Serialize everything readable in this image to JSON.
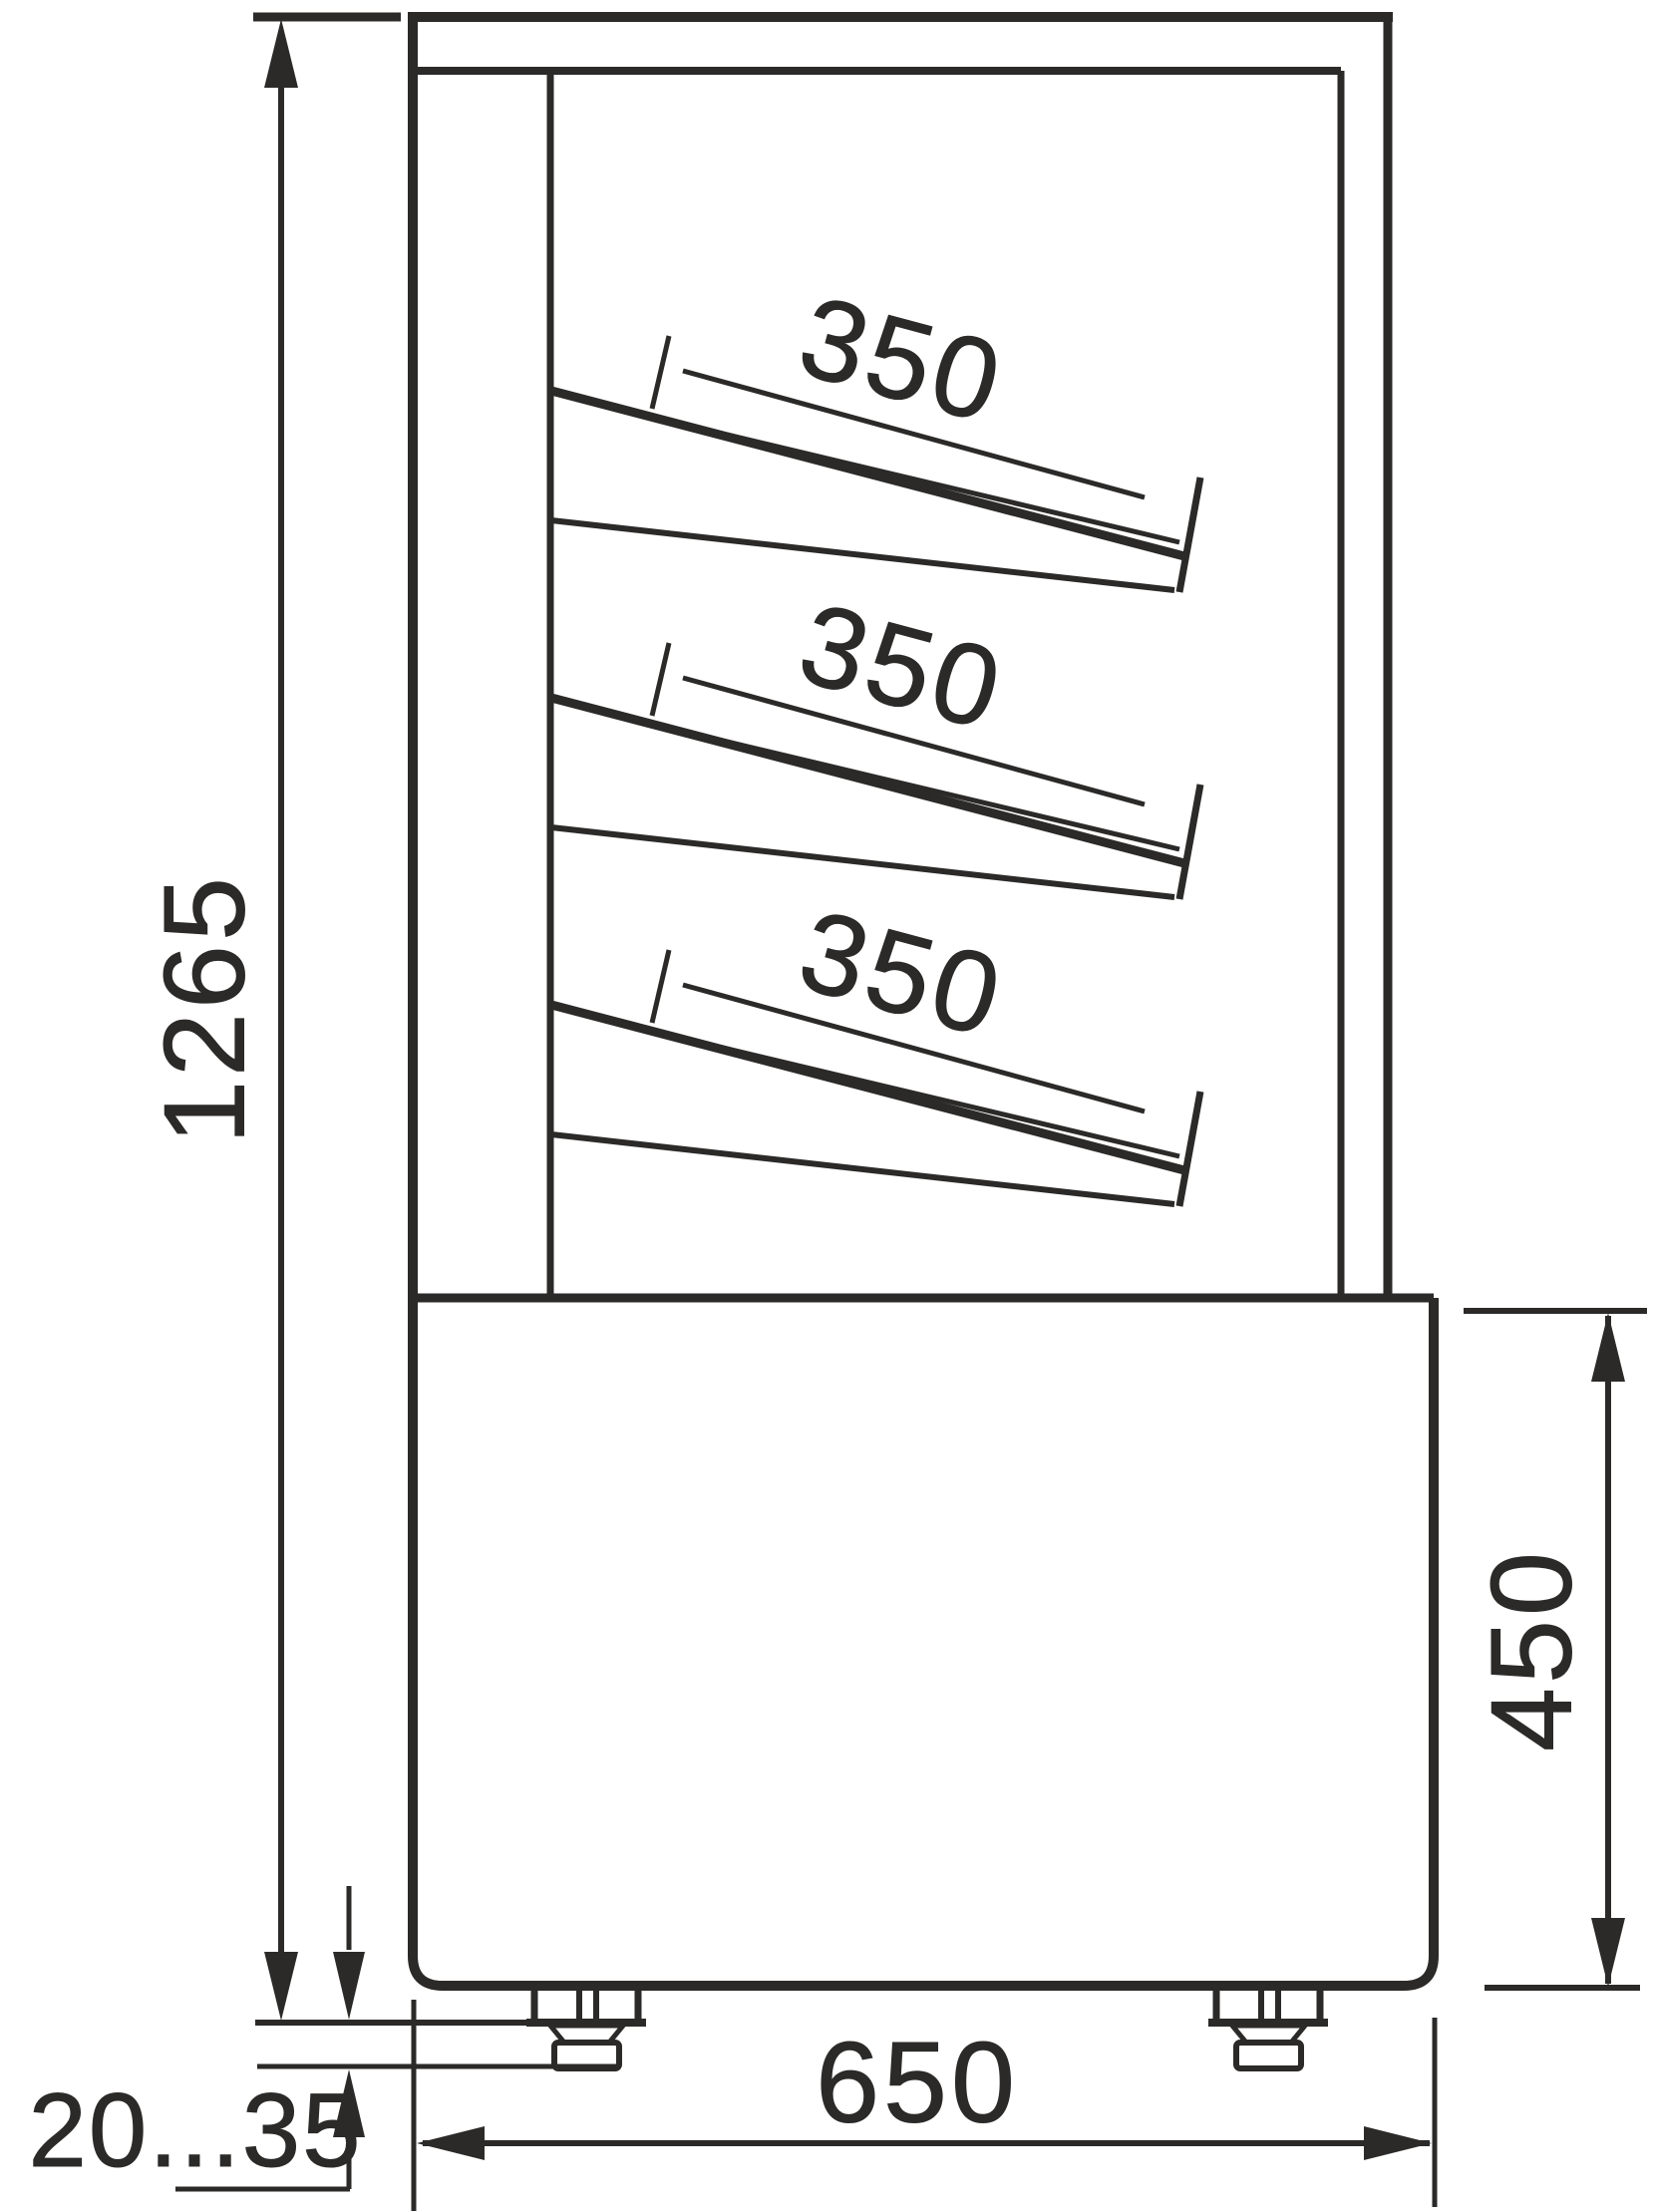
{
  "drawing": {
    "line_color": "#2b2a29",
    "background_color": "#ffffff"
  },
  "labels": {
    "overall_height": "1265",
    "shelf_depths": [
      "350",
      "350",
      "350"
    ],
    "base_height": "450",
    "base_depth": "650",
    "feet_adjust_range": "20...35"
  }
}
